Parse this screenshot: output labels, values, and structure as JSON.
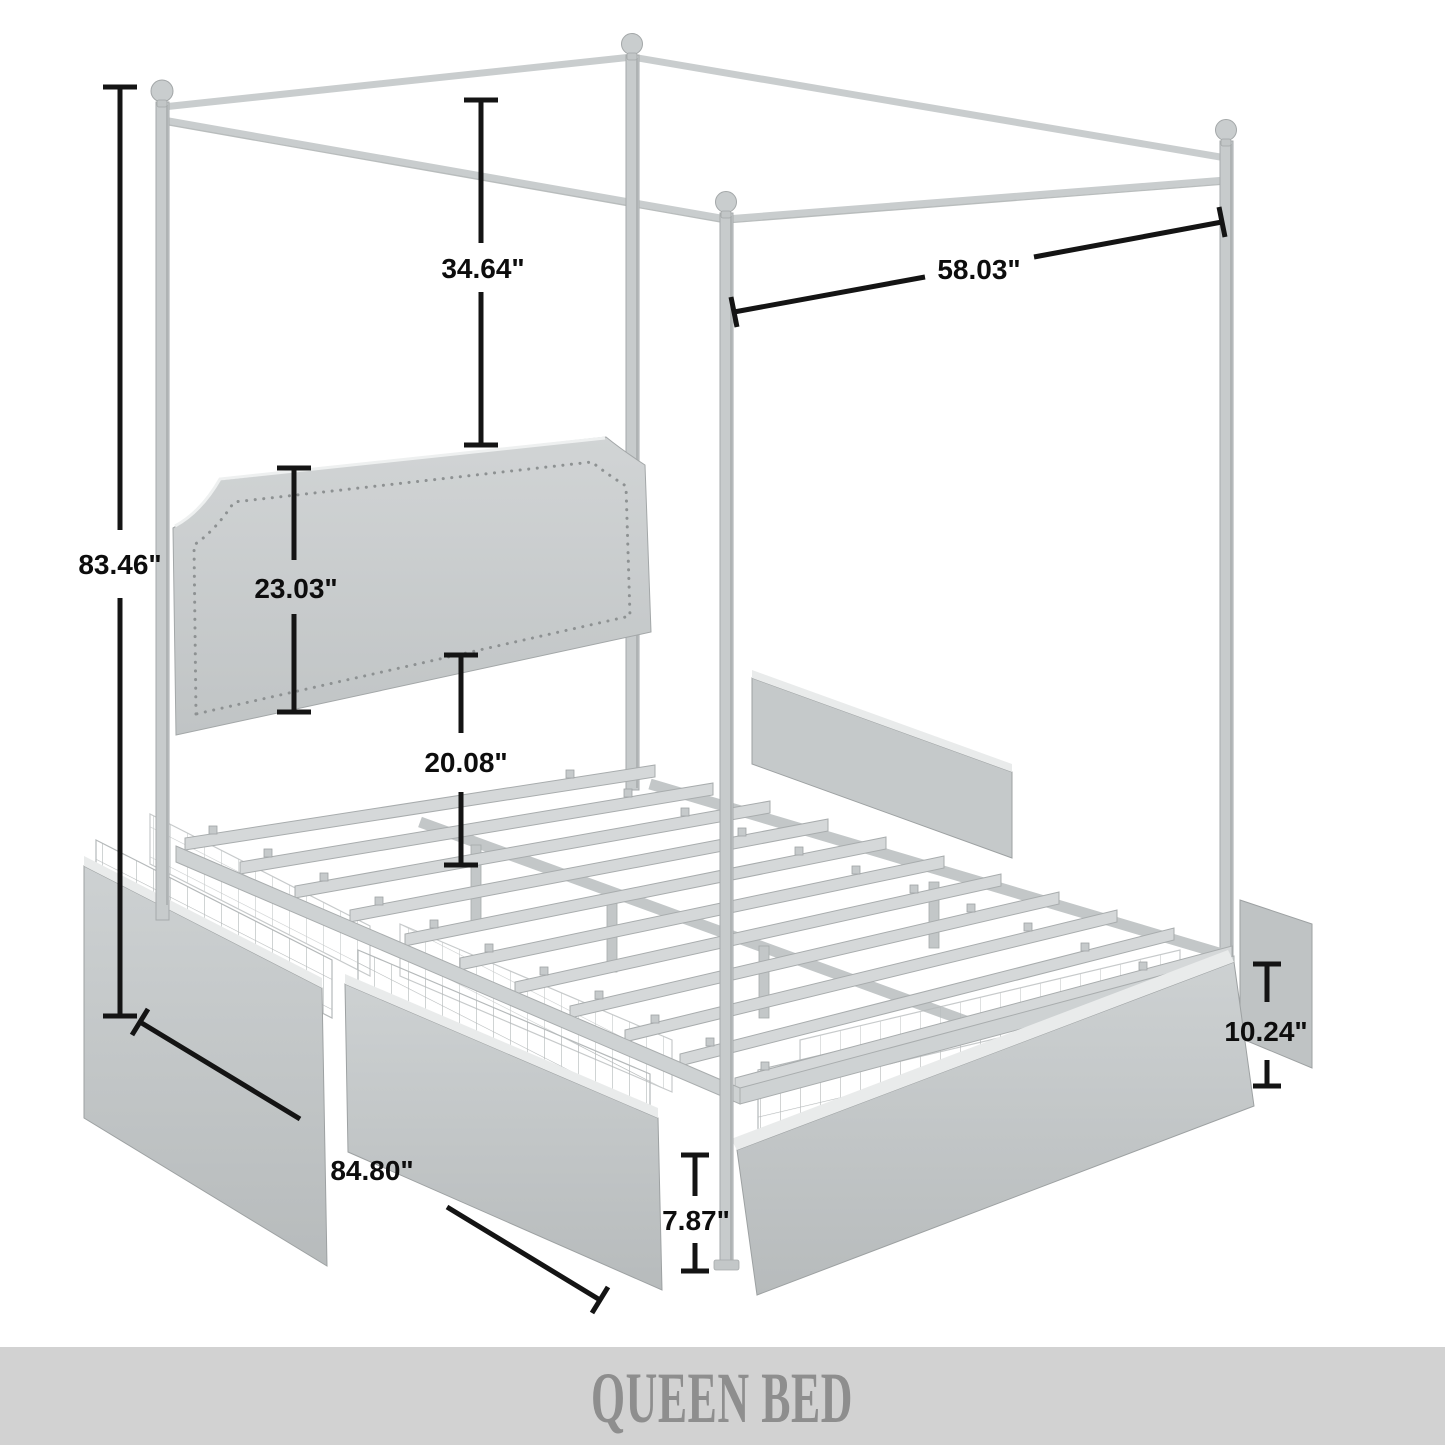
{
  "figure": {
    "kind": "product-dimension-diagram",
    "subject": "four-poster canopy bed frame with headboard, metal slats and under-bed storage drawers"
  },
  "banner": {
    "label": "QUEEN BED"
  },
  "dims": {
    "total_height": {
      "label": "83.46\""
    },
    "canopy_drop": {
      "label": "34.64\""
    },
    "canopy_width": {
      "label": "58.03\""
    },
    "headboard_height": {
      "label": "23.03\""
    },
    "platform_height": {
      "label": "20.08\""
    },
    "bed_length": {
      "label": "84.80\""
    },
    "drawer_height": {
      "label": "10.24\""
    },
    "floor_clearance": {
      "label": "7.87\""
    }
  },
  "colors": {
    "dimension_line": "#141414",
    "frame_gray": "#c7cbcc",
    "banner_bg": "#d2d2d2",
    "banner_text": "#8e8e8e"
  }
}
